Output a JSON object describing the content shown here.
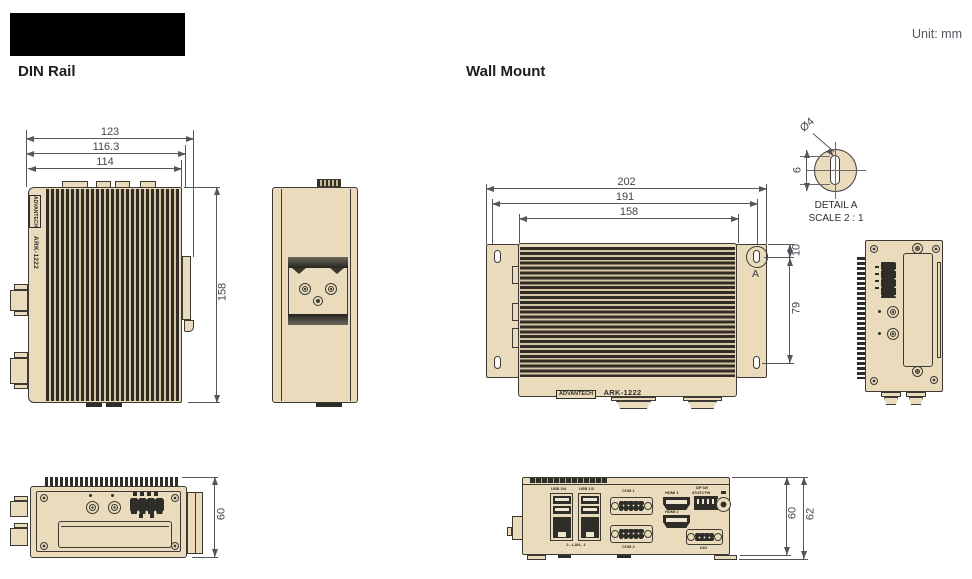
{
  "header": {
    "unit_label": "Unit: mm",
    "din_rail_title": "DIN Rail",
    "wall_mount_title": "Wall Mount"
  },
  "device": {
    "brand": "ADVANTECH",
    "model": "ARK-1222"
  },
  "din_front": {
    "width_outer": "123",
    "width_mid": "116.3",
    "width_inner": "114",
    "height": "158"
  },
  "din_bottom": {
    "height": "60"
  },
  "wall_front": {
    "width_outer": "202",
    "width_mid": "191",
    "width_inner": "158",
    "hole_top_offset": "10",
    "hole_spacing": "79",
    "detail_marker": "A"
  },
  "wall_bottom": {
    "height_body": "60",
    "height_overall": "62",
    "ports": {
      "usb_left": "USB 3/4",
      "usb_right": "USB 1/2",
      "lan": "2 –LAN– 1",
      "com1": "COM 1",
      "com2": "COM 2",
      "hdmi1": "HDMI 1",
      "hdmi2": "HDMI 2",
      "dip_line1": "DIP SW",
      "dip_line2": "AT/ATX PW",
      "dio": "DIO"
    }
  },
  "detail_a": {
    "diameter": "Ø4",
    "slot_height": "6",
    "title": "DETAIL A",
    "scale": "SCALE 2 : 1"
  }
}
